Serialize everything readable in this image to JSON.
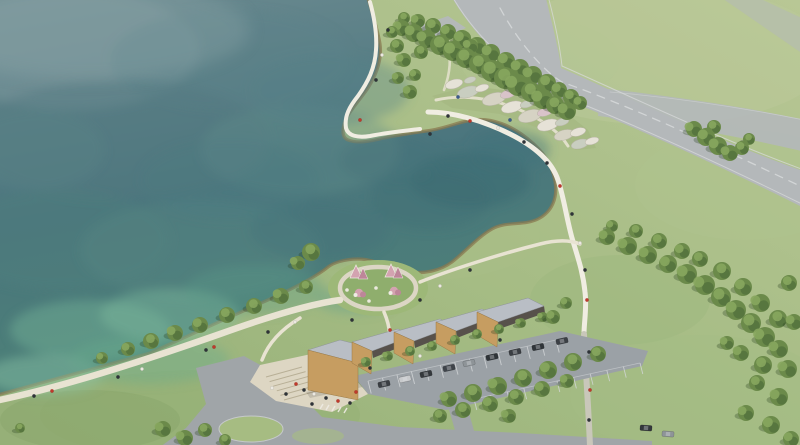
{
  "scene": {
    "description": "Aerial architectural rendering of a lakeside park: teal lake, curved shoreline promenade, flower-garden peninsula, circular play knoll, sawtooth-roofed visitor center with parking, access road and highway through green fields",
    "building_module_count": 5
  },
  "colors": {
    "grass_hi": "#b8c795",
    "grass_base": "#a4bb83",
    "grass_lo": "#96b078",
    "water_top": "#6b8a90",
    "water_mid": "#4a757d",
    "water_low": "#4d8476",
    "riprap": "#8a7950",
    "road": "#b4b8ba",
    "road_line": "#dadcdd",
    "asphalt": "#a0a5a8",
    "parking": "#9ba1a6",
    "path": "#e8e3d2",
    "path_bright": "#f0ede2",
    "ring": "#dcd6c5",
    "gray_path": "#c9c7ba",
    "plaza": "#ddd6c3",
    "step": "#b2a98f",
    "roof": "#b9bec5",
    "wall": "#c69d61",
    "shade": "#57514b",
    "tree_dark": "#4f6e3a",
    "tree_mid": "#6b8a4a",
    "tree_light": "#87a65e",
    "tree_shadow": "#28401e",
    "knoll": "#9db878",
    "knoll_in": "#8fae6d",
    "island": "#a6bc82",
    "pink": "#d3a3b0",
    "pink_dark": "#bd8699",
    "white": "#efece4",
    "stall": "#d3d6d8",
    "terrace": "#a6b983"
  },
  "people_palette": [
    "#2e3338",
    "#c0392b",
    "#ece9e1",
    "#3b5a8c"
  ],
  "water_patches": [
    [
      70,
      50,
      130,
      60,
      "#7d989e",
      0.5
    ],
    [
      230,
      60,
      120,
      50,
      "#5d8189",
      0.4
    ],
    [
      120,
      140,
      150,
      60,
      "#517a80",
      0.45
    ],
    [
      300,
      150,
      100,
      45,
      "#63908c",
      0.35
    ],
    [
      60,
      240,
      110,
      50,
      "#4f7f7d",
      0.4
    ],
    [
      200,
      250,
      120,
      50,
      "#598a84",
      0.35
    ],
    [
      90,
      330,
      80,
      30,
      "#6fae94",
      0.5
    ],
    [
      170,
      315,
      70,
      26,
      "#7fbb9e",
      0.45
    ],
    [
      45,
      375,
      60,
      20,
      "#8ac4a6",
      0.45
    ],
    [
      150,
      360,
      80,
      24,
      "#6aa98c",
      0.4
    ],
    [
      255,
      290,
      70,
      25,
      "#5d9a86",
      0.35
    ],
    [
      320,
      230,
      70,
      30,
      "#44737a",
      0.4
    ],
    [
      470,
      180,
      60,
      28,
      "#396770",
      0.5
    ],
    [
      510,
      150,
      40,
      20,
      "#41707a",
      0.4
    ],
    [
      430,
      200,
      60,
      30,
      "#3f6f76",
      0.4
    ],
    [
      390,
      160,
      50,
      25,
      "#467379",
      0.35
    ],
    [
      35,
      150,
      70,
      40,
      "#5a8288",
      0.4
    ],
    [
      330,
      90,
      80,
      35,
      "#57828a",
      0.35
    ],
    [
      230,
      180,
      90,
      40,
      "#4e7c80",
      0.35
    ],
    [
      355,
      300,
      40,
      14,
      "#63a18a",
      0.4
    ]
  ],
  "grass_patches": [
    [
      660,
      55,
      170,
      70,
      "#bcca9c",
      0.45
    ],
    [
      745,
      185,
      110,
      55,
      "#b0c48f",
      0.4
    ],
    [
      700,
      395,
      130,
      60,
      "#a5bc85",
      0.45
    ],
    [
      200,
      415,
      160,
      45,
      "#93af74",
      0.5
    ],
    [
      430,
      235,
      110,
      45,
      "#aabf87",
      0.4
    ],
    [
      620,
      300,
      90,
      45,
      "#9cb67c",
      0.4
    ],
    [
      540,
      60,
      80,
      40,
      "#b4c693",
      0.4
    ],
    [
      90,
      420,
      90,
      30,
      "#88a56a",
      0.45
    ]
  ],
  "trees": [
    [
      402,
      28,
      8
    ],
    [
      414,
      33,
      9
    ],
    [
      427,
      39,
      9
    ],
    [
      440,
      45,
      10
    ],
    [
      453,
      51,
      10
    ],
    [
      466,
      58,
      10
    ],
    [
      479,
      64,
      10
    ],
    [
      492,
      71,
      11
    ],
    [
      505,
      78,
      11
    ],
    [
      518,
      85,
      11
    ],
    [
      531,
      92,
      10
    ],
    [
      543,
      99,
      10
    ],
    [
      555,
      105,
      9
    ],
    [
      567,
      111,
      9
    ],
    [
      418,
      21,
      7
    ],
    [
      433,
      26,
      8
    ],
    [
      448,
      32,
      8
    ],
    [
      462,
      39,
      9
    ],
    [
      477,
      46,
      9
    ],
    [
      491,
      53,
      9
    ],
    [
      506,
      61,
      9
    ],
    [
      520,
      68,
      9
    ],
    [
      533,
      75,
      9
    ],
    [
      547,
      83,
      9
    ],
    [
      559,
      90,
      8
    ],
    [
      571,
      97,
      8
    ],
    [
      580,
      103,
      7
    ],
    [
      397,
      46,
      7
    ],
    [
      404,
      60,
      7
    ],
    [
      398,
      78,
      6
    ],
    [
      410,
      92,
      7
    ],
    [
      421,
      52,
      7
    ],
    [
      415,
      75,
      6
    ],
    [
      392,
      32,
      6
    ],
    [
      404,
      18,
      6
    ],
    [
      464,
      38,
      7
    ],
    [
      471,
      46,
      7
    ],
    [
      694,
      129,
      8
    ],
    [
      706,
      137,
      9
    ],
    [
      718,
      146,
      9
    ],
    [
      730,
      153,
      8
    ],
    [
      742,
      148,
      7
    ],
    [
      714,
      127,
      7
    ],
    [
      749,
      139,
      6
    ],
    [
      607,
      237,
      8
    ],
    [
      628,
      246,
      9
    ],
    [
      648,
      255,
      9
    ],
    [
      668,
      264,
      9
    ],
    [
      687,
      274,
      10
    ],
    [
      705,
      285,
      10
    ],
    [
      721,
      297,
      10
    ],
    [
      736,
      310,
      10
    ],
    [
      751,
      323,
      10
    ],
    [
      765,
      337,
      10
    ],
    [
      700,
      259,
      8
    ],
    [
      722,
      271,
      9
    ],
    [
      743,
      287,
      9
    ],
    [
      761,
      303,
      9
    ],
    [
      778,
      319,
      9
    ],
    [
      789,
      283,
      8
    ],
    [
      636,
      231,
      7
    ],
    [
      659,
      241,
      8
    ],
    [
      682,
      251,
      8
    ],
    [
      612,
      226,
      6
    ],
    [
      779,
      349,
      9
    ],
    [
      763,
      365,
      9
    ],
    [
      741,
      353,
      8
    ],
    [
      788,
      369,
      9
    ],
    [
      757,
      383,
      8
    ],
    [
      779,
      397,
      9
    ],
    [
      746,
      413,
      8
    ],
    [
      771,
      425,
      9
    ],
    [
      791,
      439,
      8
    ],
    [
      727,
      343,
      7
    ],
    [
      794,
      322,
      8
    ],
    [
      128,
      349,
      7
    ],
    [
      151,
      341,
      8
    ],
    [
      175,
      333,
      8
    ],
    [
      200,
      325,
      8
    ],
    [
      227,
      315,
      8
    ],
    [
      254,
      306,
      8
    ],
    [
      281,
      296,
      8
    ],
    [
      306,
      287,
      7
    ],
    [
      102,
      358,
      6
    ],
    [
      163,
      429,
      8
    ],
    [
      185,
      438,
      8
    ],
    [
      20,
      428,
      5
    ],
    [
      449,
      399,
      8
    ],
    [
      473,
      393,
      9
    ],
    [
      498,
      386,
      9
    ],
    [
      523,
      378,
      9
    ],
    [
      548,
      370,
      9
    ],
    [
      573,
      362,
      9
    ],
    [
      598,
      354,
      8
    ],
    [
      463,
      410,
      8
    ],
    [
      490,
      404,
      8
    ],
    [
      516,
      397,
      8
    ],
    [
      542,
      389,
      8
    ],
    [
      567,
      381,
      7
    ],
    [
      440,
      416,
      7
    ],
    [
      509,
      416,
      7
    ],
    [
      366,
      362,
      5
    ],
    [
      388,
      356,
      5
    ],
    [
      410,
      351,
      5
    ],
    [
      432,
      346,
      5
    ],
    [
      455,
      340,
      5
    ],
    [
      477,
      334,
      5
    ],
    [
      499,
      329,
      5
    ],
    [
      521,
      323,
      5
    ],
    [
      543,
      317,
      5
    ],
    [
      553,
      317,
      7
    ],
    [
      566,
      303,
      6
    ],
    [
      311,
      252,
      9
    ],
    [
      298,
      263,
      7
    ],
    [
      205,
      430,
      7
    ],
    [
      225,
      440,
      6
    ]
  ],
  "garden_beds": [
    [
      454,
      84,
      9,
      4.5,
      "#e6e2d7"
    ],
    [
      468,
      92,
      11,
      5.5,
      "#c9cec0"
    ],
    [
      482,
      88,
      7,
      3.5,
      "#e6e2d7"
    ],
    [
      494,
      99,
      12,
      6,
      "#d6d3c4"
    ],
    [
      508,
      94,
      8,
      4,
      "#d9c3c9"
    ],
    [
      512,
      107,
      11,
      5.5,
      "#e6e2d7"
    ],
    [
      527,
      104,
      7,
      3.5,
      "#c9cec0"
    ],
    [
      530,
      116,
      12,
      6,
      "#d6d3c4"
    ],
    [
      545,
      112,
      8,
      4,
      "#d9c3c9"
    ],
    [
      548,
      125,
      11,
      5.5,
      "#e6e2d7"
    ],
    [
      562,
      122,
      7,
      3.5,
      "#c9cec0"
    ],
    [
      564,
      135,
      10,
      5,
      "#d6d3c4"
    ],
    [
      578,
      132,
      8,
      4,
      "#e6e2d7"
    ],
    [
      580,
      144,
      9,
      4.5,
      "#c9cec0"
    ],
    [
      592,
      141,
      7,
      3.5,
      "#e6e2d7"
    ],
    [
      470,
      80,
      6,
      3,
      "#c9cec0"
    ]
  ],
  "building_modules": [
    {
      "roof": "308,350 340,340 376,349 358,363",
      "wall": "308,350 358,363 358,400 308,390",
      "shade": ""
    },
    {
      "roof": "352,342 398,329 412,336 372,351",
      "wall": "352,342 372,351 371,374 352,363",
      "shade": "372,351 412,336 413,342 373,358"
    },
    {
      "roof": "394,332 440,319 454,326 414,341",
      "wall": "394,332 414,341 413,364 394,353",
      "shade": "414,341 454,326 455,332 415,348"
    },
    {
      "roof": "436,322 482,309 496,316 456,331",
      "wall": "436,322 456,331 455,354 436,343",
      "shade": "456,331 496,316 497,322 457,338"
    },
    {
      "roof": "477,312 528,298 544,306 498,322",
      "wall": "477,312 498,322 497,347 477,335",
      "shade": "498,322 544,306 545,313 499,329"
    }
  ],
  "stall_rows": [
    {
      "x0": 368,
      "y0": 381,
      "x1": 556,
      "y1": 340,
      "n": 13,
      "px": 3.2,
      "py": 12.5
    },
    {
      "x0": 474,
      "y0": 399,
      "x1": 640,
      "y1": 363,
      "n": 10,
      "px": 2.8,
      "py": 11
    }
  ],
  "plaza_steps": {
    "x0": 266,
    "y0": 377,
    "x1": 302,
    "y1": 367,
    "dx": 3.6,
    "dy": 4.6,
    "n": 6
  },
  "cars": [
    [
      384,
      384,
      "#3a3e43",
      -12
    ],
    [
      405,
      379,
      "#c8cacc",
      -12
    ],
    [
      426,
      374,
      "#34383c",
      -12
    ],
    [
      449,
      368,
      "#3f444a",
      -12
    ],
    [
      469,
      363,
      "#8e9498",
      -12
    ],
    [
      492,
      357,
      "#2f3438",
      -12
    ],
    [
      515,
      352,
      "#3a3e43",
      -12
    ],
    [
      538,
      347,
      "#303539",
      -12
    ],
    [
      562,
      341,
      "#3c4045",
      -12
    ],
    [
      646,
      428,
      "#34383c",
      4
    ],
    [
      668,
      434,
      "#8e9498",
      4
    ]
  ],
  "people": [
    [
      34,
      396,
      0
    ],
    [
      52,
      391,
      1
    ],
    [
      118,
      377,
      0
    ],
    [
      142,
      369,
      2
    ],
    [
      206,
      350,
      0
    ],
    [
      214,
      347,
      1
    ],
    [
      268,
      332,
      0
    ],
    [
      295,
      322,
      2
    ],
    [
      448,
      116,
      0
    ],
    [
      470,
      121,
      1
    ],
    [
      498,
      128,
      2
    ],
    [
      524,
      142,
      0
    ],
    [
      547,
      163,
      0
    ],
    [
      560,
      186,
      1
    ],
    [
      572,
      214,
      0
    ],
    [
      580,
      243,
      2
    ],
    [
      585,
      270,
      0
    ],
    [
      587,
      300,
      1
    ],
    [
      388,
      30,
      0
    ],
    [
      382,
      55,
      2
    ],
    [
      376,
      80,
      0
    ],
    [
      360,
      120,
      1
    ],
    [
      430,
      134,
      0
    ],
    [
      352,
      320,
      0
    ],
    [
      390,
      330,
      1
    ],
    [
      420,
      300,
      0
    ],
    [
      440,
      286,
      2
    ],
    [
      470,
      270,
      0
    ],
    [
      296,
      384,
      1
    ],
    [
      304,
      390,
      0
    ],
    [
      314,
      394,
      2
    ],
    [
      326,
      398,
      0
    ],
    [
      338,
      401,
      1
    ],
    [
      286,
      394,
      0
    ],
    [
      272,
      388,
      2
    ],
    [
      350,
      403,
      0
    ],
    [
      356,
      392,
      1
    ],
    [
      312,
      404,
      0
    ],
    [
      589,
      352,
      0
    ],
    [
      590,
      390,
      1
    ],
    [
      589,
      420,
      0
    ],
    [
      370,
      368,
      0
    ],
    [
      420,
      356,
      2
    ],
    [
      500,
      340,
      0
    ],
    [
      458,
      97,
      3
    ],
    [
      510,
      120,
      3
    ]
  ],
  "playground": {
    "tents": [
      [
        356,
        272
      ],
      [
        391,
        271
      ]
    ],
    "mounds": [
      [
        359,
        293
      ],
      [
        394,
        291
      ]
    ],
    "dots": [
      [
        347,
        290
      ],
      [
        376,
        288
      ],
      [
        369,
        301
      ]
    ]
  }
}
